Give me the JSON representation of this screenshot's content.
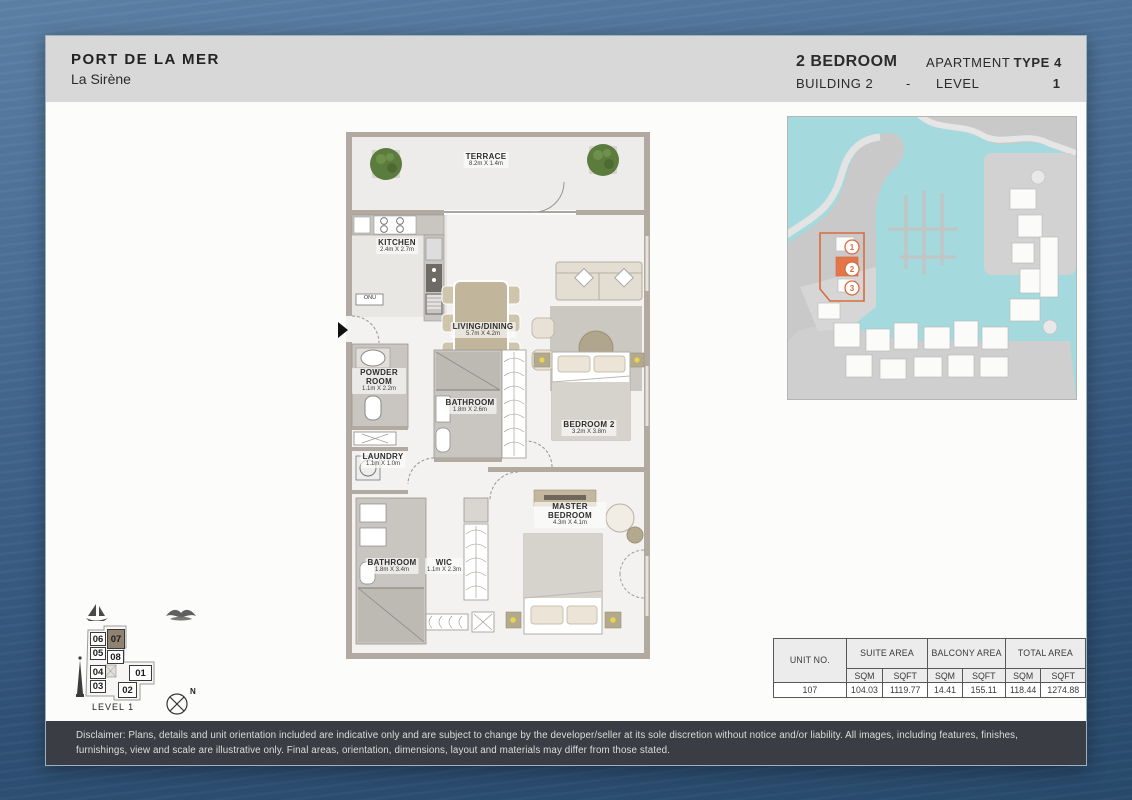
{
  "header": {
    "project": "PORT DE LA MER",
    "subtitle": "La Sirène",
    "bedrooms": "2 BEDROOM",
    "building": "BUILDING 2",
    "separator": "-",
    "apartment_label": "APARTMENT",
    "apartment_type": "TYPE 4",
    "level_label": "LEVEL",
    "level_value": "1"
  },
  "floorplan": {
    "onu_label": "ONU",
    "rooms": [
      {
        "name": "TERRACE",
        "dims": "8.2m X 1.4m"
      },
      {
        "name": "KITCHEN",
        "dims": "2.4m X 2.7m"
      },
      {
        "name": "LIVING/DINING",
        "dims": "5.7m X 4.2m"
      },
      {
        "name": "POWDER ROOM",
        "dims": "1.1m X 2.2m"
      },
      {
        "name": "BATHROOM",
        "dims": "1.8m X 2.6m"
      },
      {
        "name": "BEDROOM 2",
        "dims": "3.2m X 3.8m"
      },
      {
        "name": "LAUNDRY",
        "dims": "1.1m X 1.0m"
      },
      {
        "name": "MASTER BEDROOM",
        "dims": "4.3m X 4.1m"
      },
      {
        "name": "BATHROOM",
        "dims": "1.8m X 3.4m"
      },
      {
        "name": "WIC",
        "dims": "1.1m X 2.3m"
      }
    ]
  },
  "sitemap": {
    "markers": [
      "1",
      "2",
      "3"
    ]
  },
  "keyplan": {
    "units": [
      {
        "label": "06"
      },
      {
        "label": "07",
        "highlighted": true
      },
      {
        "label": "05"
      },
      {
        "label": "08"
      },
      {
        "label": "04"
      },
      {
        "label": "01"
      },
      {
        "label": "03"
      },
      {
        "label": "02"
      }
    ],
    "level_label": "LEVEL 1",
    "north": "N"
  },
  "area_table": {
    "unit_no_header": "UNIT NO.",
    "suite_header": "SUITE AREA",
    "balcony_header": "BALCONY AREA",
    "total_header": "TOTAL AREA",
    "sqm": "SQM",
    "sqft": "SQFT",
    "row": {
      "unit": "107",
      "suite_sqm": "104.03",
      "suite_sqft": "1119.77",
      "balcony_sqm": "14.41",
      "balcony_sqft": "155.11",
      "total_sqm": "118.44",
      "total_sqft": "1274.88"
    }
  },
  "disclaimer": "Disclaimer: Plans, details and unit orientation included are indicative only and are subject to change by the developer/seller at its sole discretion without notice and/or liability. All images, including features, finishes, furnishings, view and scale are illustrative only. Final areas, orientation, dimensions, layout and materials may differ from those stated.",
  "colors": {
    "accent_orange": "#dd6f43",
    "water_teal": "#a4d9dd",
    "header_gray": "#d8d8d8",
    "disclaimer_bar": "#3a3d43",
    "wall_taupe": "#b2a9a0"
  }
}
